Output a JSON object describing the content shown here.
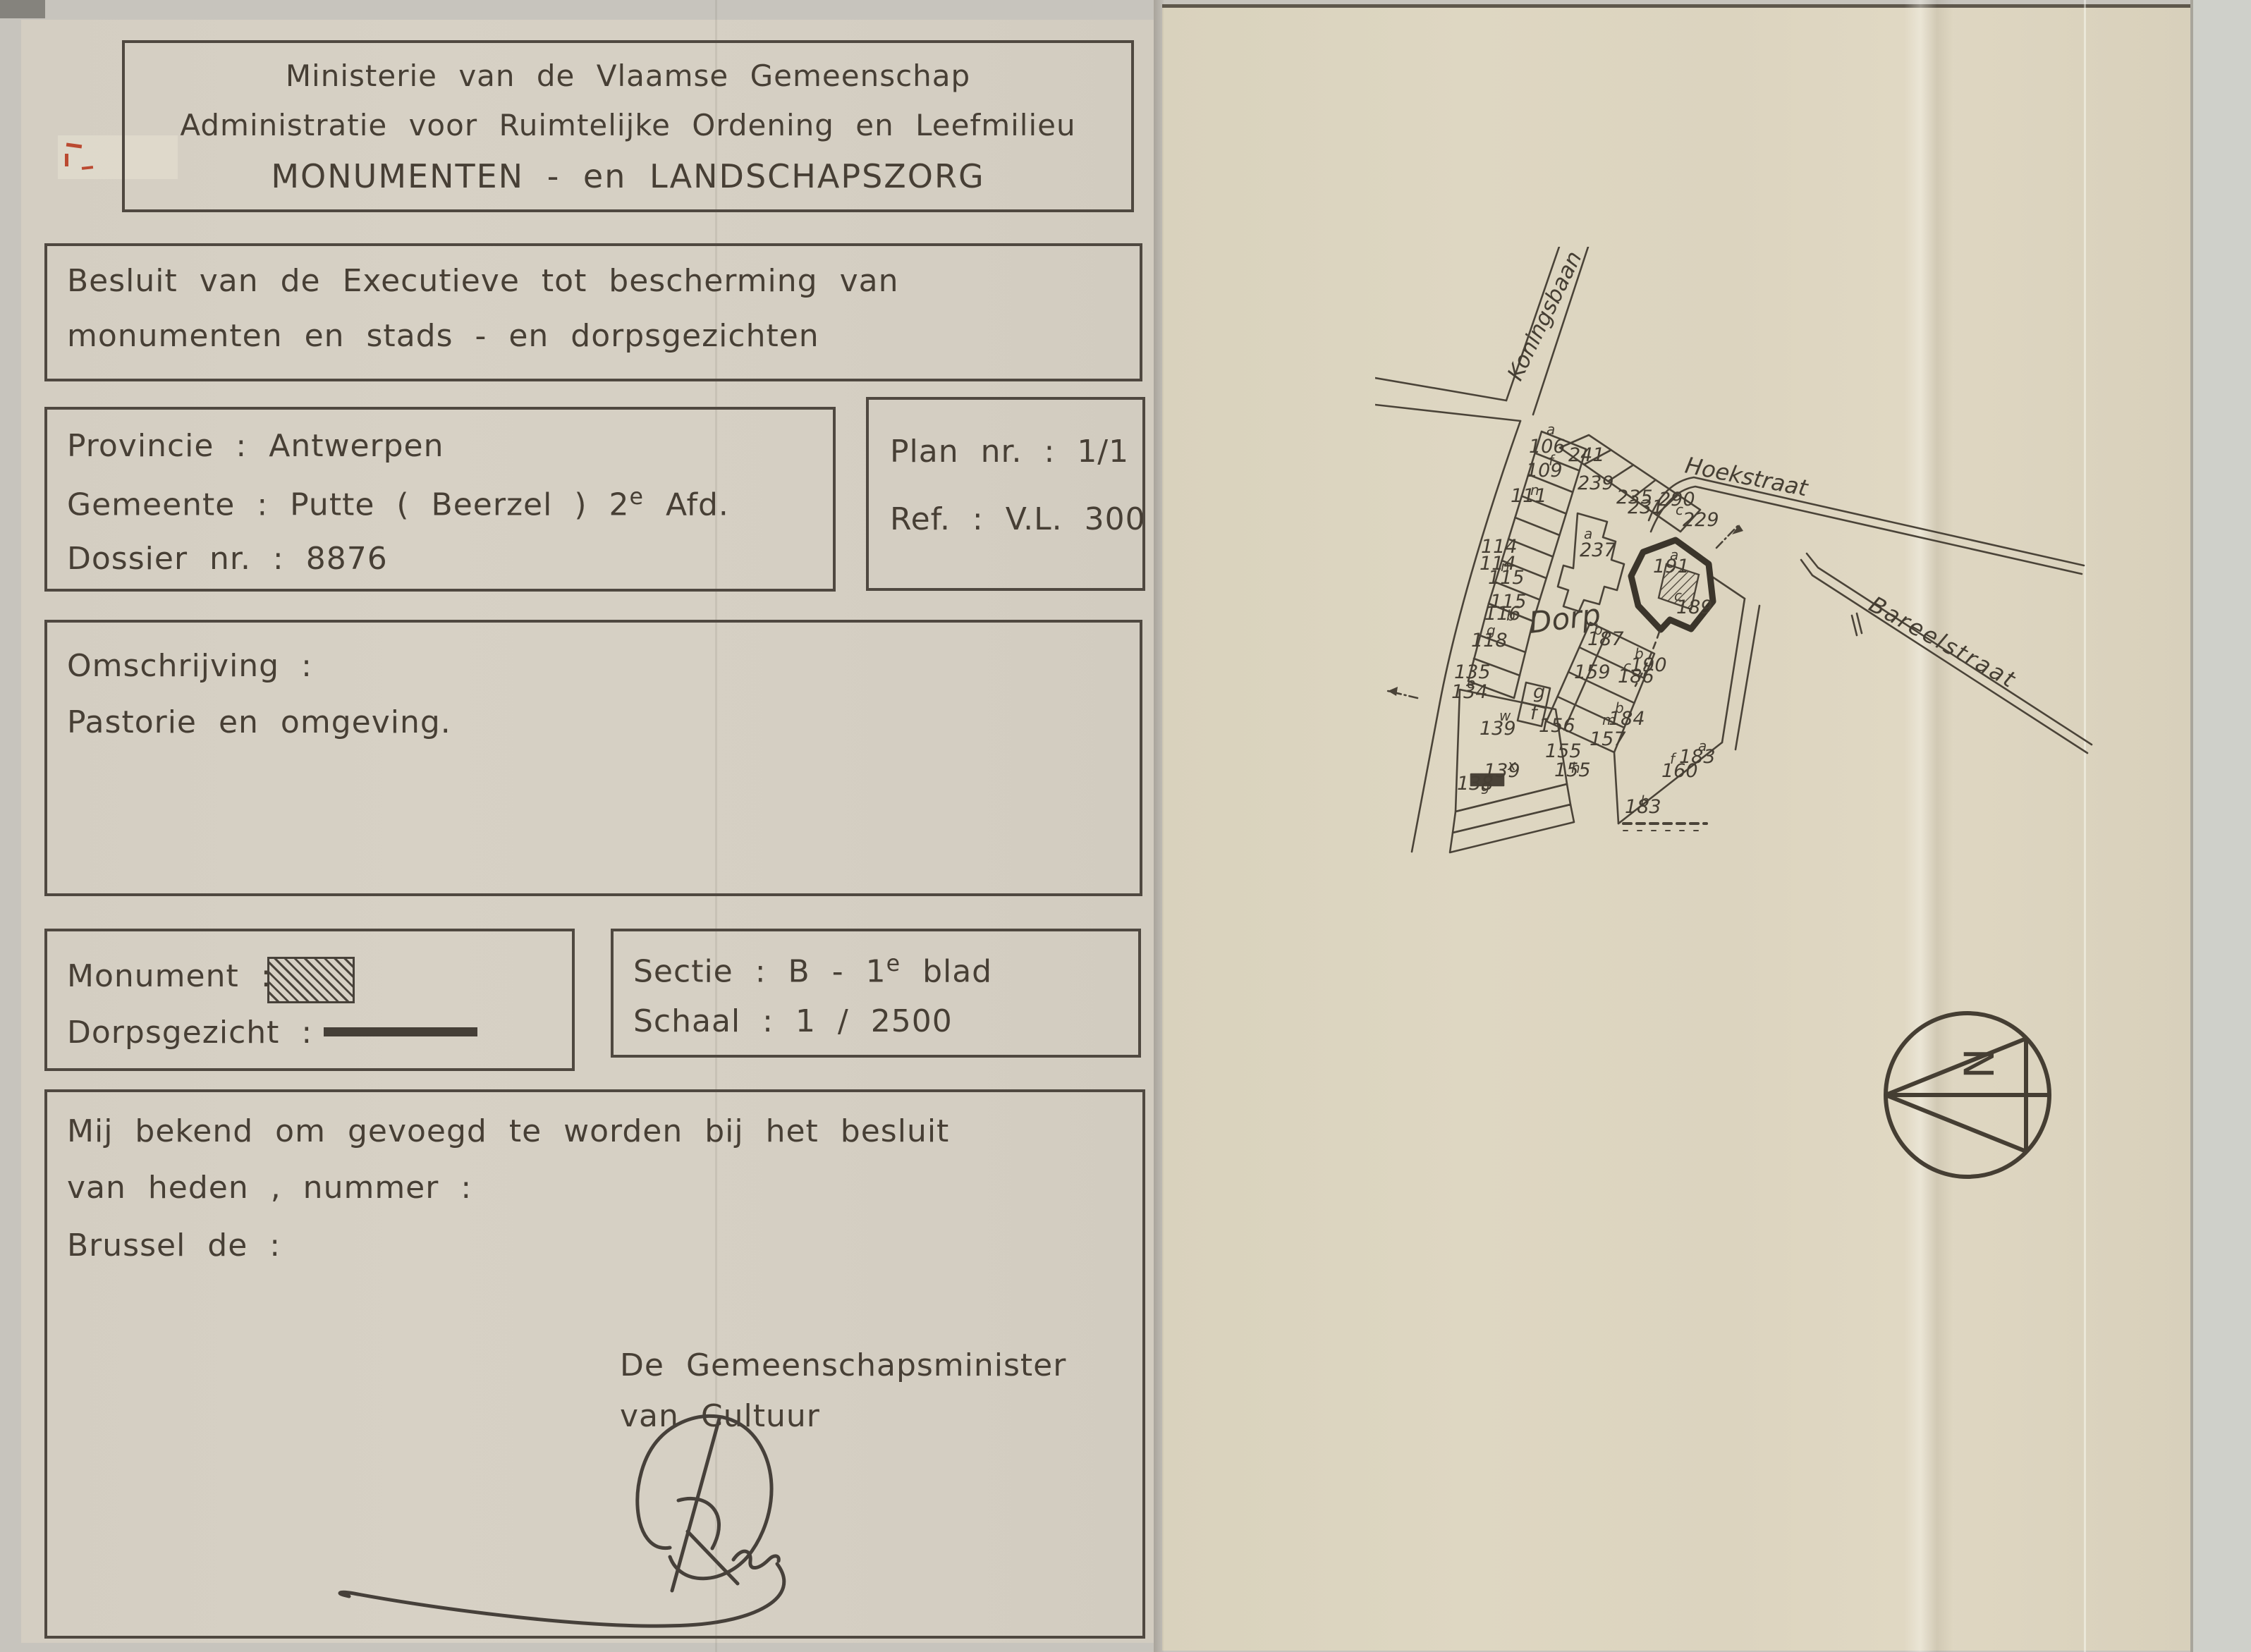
{
  "page": {
    "header": {
      "line1": "Ministerie van de Vlaamse Gemeenschap",
      "line2": "Administratie voor Ruimtelijke Ordening en Leefmilieu",
      "line3": "MONUMENTEN - en LANDSCHAPSZORG"
    },
    "decree": {
      "line1": "Besluit van de Executieve tot bescherming van",
      "line2": "monumenten en stads - en dorpsgezichten"
    },
    "dossier": {
      "provincie": "Provincie : Antwerpen",
      "gemeente_pre": "Gemeente : Putte ( Beerzel ) 2",
      "gemeente_sup": "e",
      "gemeente_post": " Afd.",
      "dossier": "Dossier nr. : 8876"
    },
    "plan": {
      "plan": "Plan nr. : 1/1",
      "ref": "Ref. : V.L. 300"
    },
    "omschrijving": {
      "label": "Omschrijving :",
      "value": "Pastorie en omgeving."
    },
    "legend": {
      "monument": "Monument :",
      "dorpsgezicht": "Dorpsgezicht :"
    },
    "sectie": {
      "sectie_pre": "Sectie : B - 1",
      "sectie_sup": "e",
      "sectie_post": " blad",
      "schaal": "Schaal : 1 / 2500"
    },
    "closing": {
      "line1": "Mij bekend om gevoegd te worden bij het besluit",
      "line2": "van heden , nummer :",
      "line3": "Brussel de :",
      "minister1": "De Gemeenschapsminister",
      "minister2": "van Cultuur"
    }
  },
  "map": {
    "streets": {
      "koningsbaan": "Koningsbaan",
      "hoekstraat": "Hoekstraat",
      "bareelstraat": "Bareelstraat"
    },
    "area": "Dorp",
    "north_letter": "N",
    "parcels": [
      {
        "n": "106",
        "s": "a"
      },
      {
        "n": "109",
        "s": "f"
      },
      {
        "n": "111",
        "s": "n"
      },
      {
        "n": "114",
        "s": ""
      },
      {
        "n": "114",
        "s": "n"
      },
      {
        "n": "115",
        "s": ""
      },
      {
        "n": "115",
        "s": ""
      },
      {
        "n": "116",
        "s": "b"
      },
      {
        "n": "118",
        "s": "g"
      },
      {
        "n": "135",
        "s": ""
      },
      {
        "n": "134",
        "s": "e"
      },
      {
        "n": "139",
        "s": "w"
      },
      {
        "n": "139",
        "s": "x"
      },
      {
        "n": "138",
        "s": "g"
      },
      {
        "n": "241",
        "s": ""
      },
      {
        "n": "239",
        "s": ""
      },
      {
        "n": "235",
        "s": ""
      },
      {
        "n": "231",
        "s": ""
      },
      {
        "n": "290",
        "s": ""
      },
      {
        "n": "229",
        "s": "c"
      },
      {
        "n": "237",
        "s": "a"
      },
      {
        "n": "191",
        "s": "a"
      },
      {
        "n": "189",
        "s": "c"
      },
      {
        "n": "187",
        "s": "b"
      },
      {
        "n": "159",
        "s": ""
      },
      {
        "n": "186",
        "s": "c"
      },
      {
        "n": "156",
        "s": ""
      },
      {
        "n": "157",
        "s": "m"
      },
      {
        "n": "155",
        "s": ""
      },
      {
        "n": "155",
        "s": "h"
      },
      {
        "n": "190",
        "s": "b"
      },
      {
        "n": "184",
        "s": "b"
      },
      {
        "n": "160",
        "s": "f"
      },
      {
        "n": "183",
        "s": "a"
      },
      {
        "n": "183",
        "s": "b"
      },
      {
        "n": "g",
        "s": ""
      },
      {
        "n": "f",
        "s": ""
      }
    ]
  }
}
